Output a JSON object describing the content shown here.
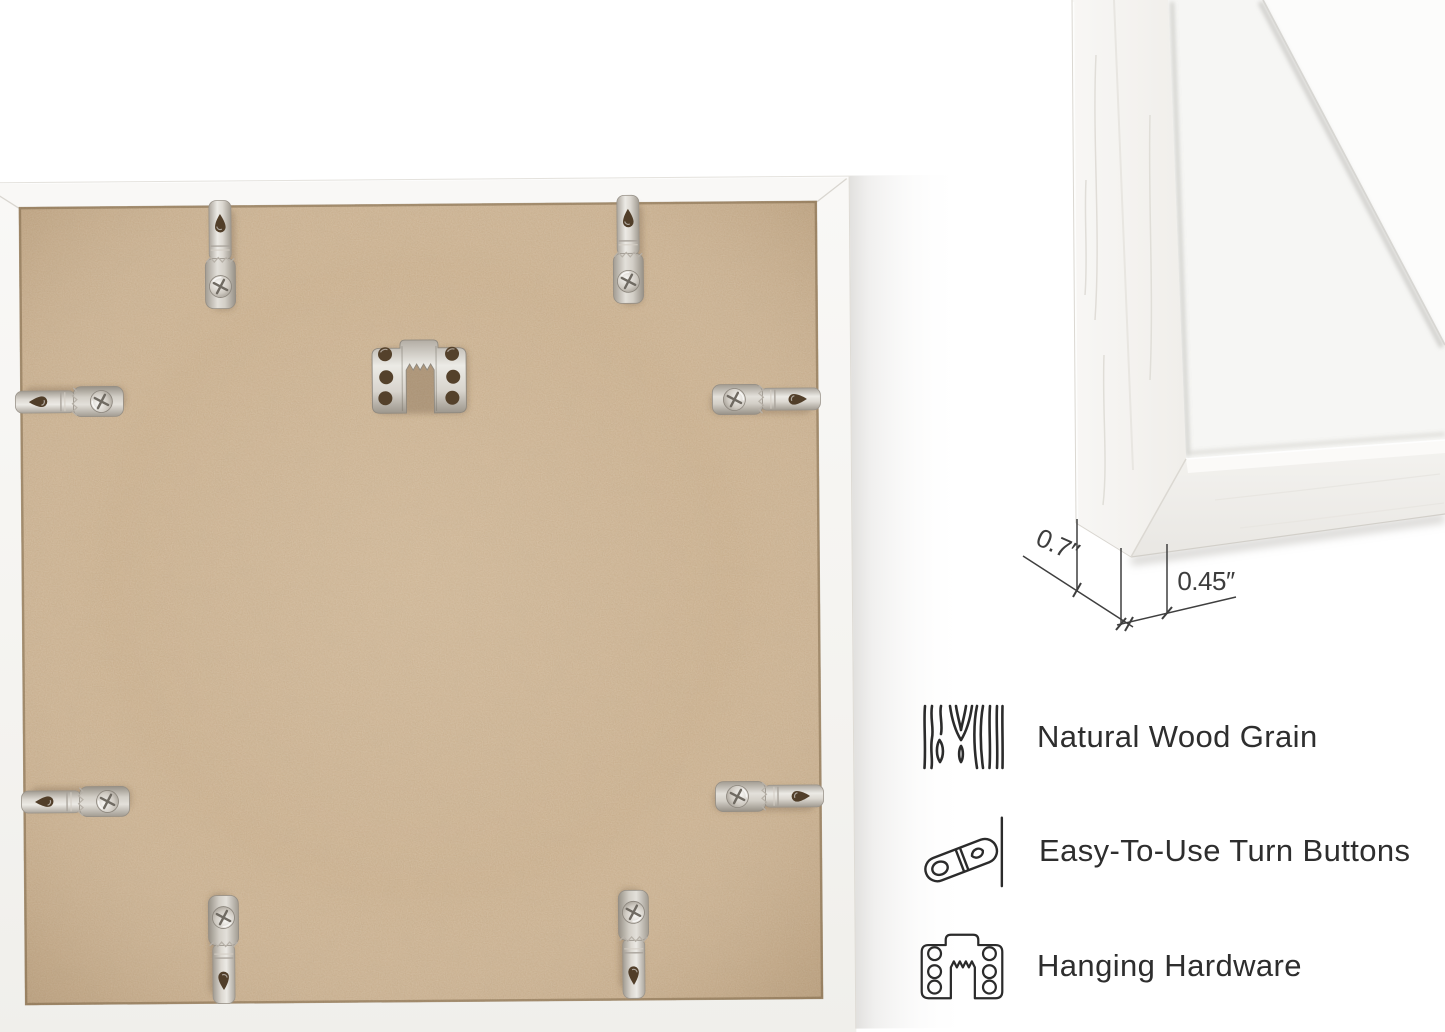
{
  "scene": {
    "background_color": "#ffffff",
    "wall_shadow_color": "#d9d7d4",
    "text_color": "#2e2e2e"
  },
  "frame_back_photo": {
    "backing_color": "#cbae8a",
    "frame_color": "#f6f5f2",
    "hardware_metal_color": "#d9d5ce",
    "turn_button_count": 8,
    "sawtooth_hanger_count": 1
  },
  "corner_detail_photo": {
    "moulding_color": "#f5f4f1",
    "mat_color": "#f6f6f4"
  },
  "dimensions": {
    "depth_label": "0.7″",
    "face_label": "0.45″"
  },
  "features": [
    {
      "icon": "wood-grain-icon",
      "label": "Natural Wood Grain"
    },
    {
      "icon": "turn-button-icon",
      "label": "Easy-To-Use Turn Buttons"
    },
    {
      "icon": "hanging-hardware-icon",
      "label": "Hanging Hardware"
    }
  ]
}
